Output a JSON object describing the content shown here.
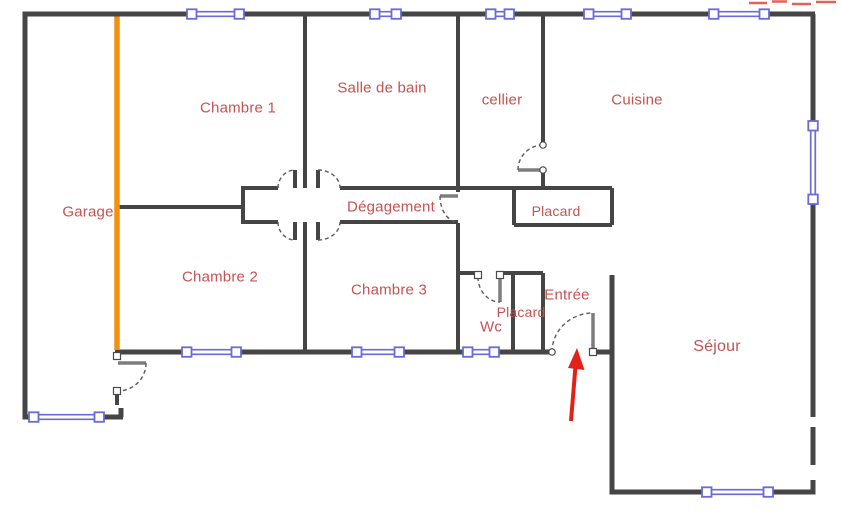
{
  "floor_plan": {
    "rooms": [
      {
        "id": "garage",
        "label": "Garage",
        "x": 88,
        "y": 212,
        "size": 15
      },
      {
        "id": "chambre-1",
        "label": "Chambre 1",
        "x": 238,
        "y": 108,
        "size": 15
      },
      {
        "id": "salle-de-bain",
        "label": "Salle de bain",
        "x": 382,
        "y": 88,
        "size": 15
      },
      {
        "id": "cellier",
        "label": "cellier",
        "x": 502,
        "y": 100,
        "size": 15
      },
      {
        "id": "cuisine",
        "label": "Cuisine",
        "x": 637,
        "y": 100,
        "size": 15
      },
      {
        "id": "degagement",
        "label": "Dégagement",
        "x": 391,
        "y": 207,
        "size": 15
      },
      {
        "id": "placard-couloir",
        "label": "Placard",
        "x": 556,
        "y": 211,
        "size": 14
      },
      {
        "id": "chambre-2",
        "label": "Chambre 2",
        "x": 220,
        "y": 277,
        "size": 15
      },
      {
        "id": "chambre-3",
        "label": "Chambre 3",
        "x": 389,
        "y": 290,
        "size": 15
      },
      {
        "id": "placard-entree",
        "label": "Placard",
        "x": 521,
        "y": 312,
        "size": 14
      },
      {
        "id": "wc",
        "label": "Wc",
        "x": 491,
        "y": 327,
        "size": 15
      },
      {
        "id": "entree",
        "label": "Entrée",
        "x": 567,
        "y": 295,
        "size": 15
      },
      {
        "id": "sejour",
        "label": "Séjour",
        "x": 717,
        "y": 347,
        "size": 16
      }
    ],
    "colors": {
      "wall": "#454545",
      "window": "#6a6ad9",
      "highlighted_wall": "#f29111",
      "room_label": "#c75252",
      "entrance_arrow": "#e32119",
      "door_leaf": "#7d7d7d"
    }
  }
}
